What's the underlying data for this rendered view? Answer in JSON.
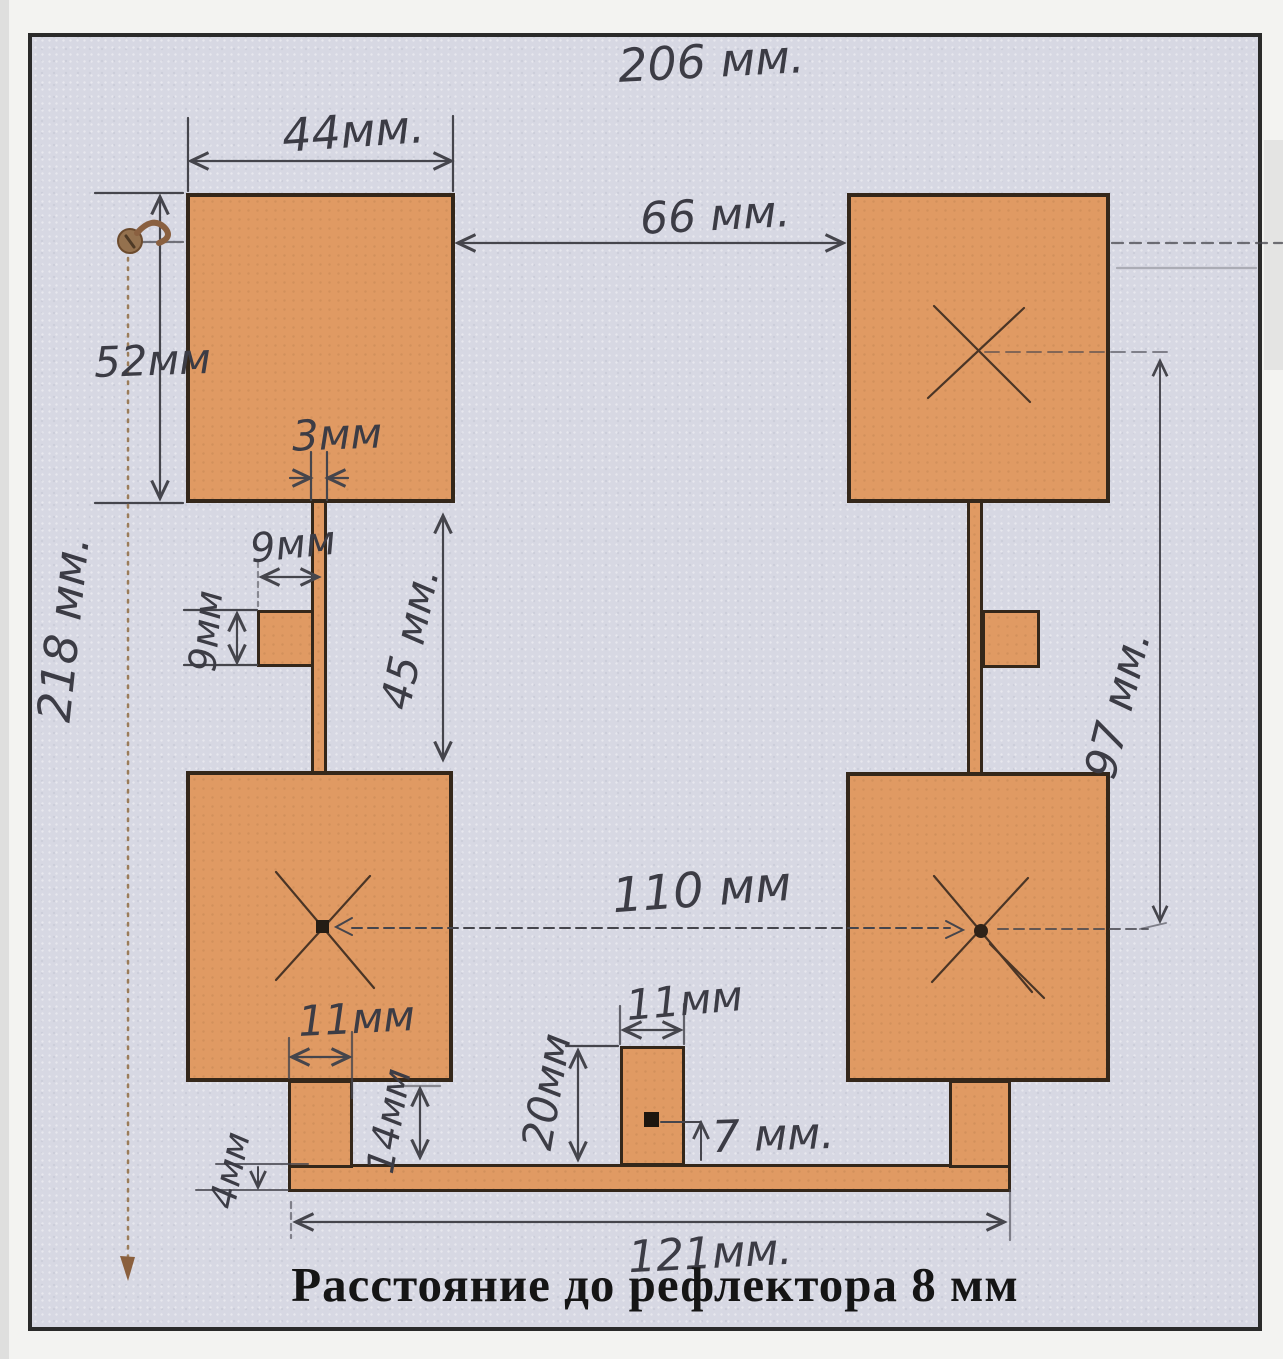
{
  "caption": "Расстояние до рефлектора 8 мм",
  "labels": {
    "total_width_top": "206 мм.",
    "patch_width": "44мм.",
    "top_gap": "66 мм.",
    "patch_height": "52мм",
    "feed_width": "3мм",
    "tab_width": "9мм",
    "tab_height": "9мм",
    "feed_length": "45 мм.",
    "center_spacing_v": "97 мм.",
    "total_height": "218 мм.",
    "center_spacing_h": "110 мм",
    "lower_tab_width": "11мм",
    "lower_tab_height": "14мм",
    "stub_height": "20мм",
    "stub_width": "11мм",
    "feed_offset": "7 мм.",
    "bus_thickness": "4мм",
    "bus_length": "121мм."
  },
  "colors": {
    "copper": "#e09a63",
    "outline": "#34271a",
    "background": "#d7d8e3",
    "ink": "#45454c",
    "pencil_brown": "#9b7c59"
  }
}
